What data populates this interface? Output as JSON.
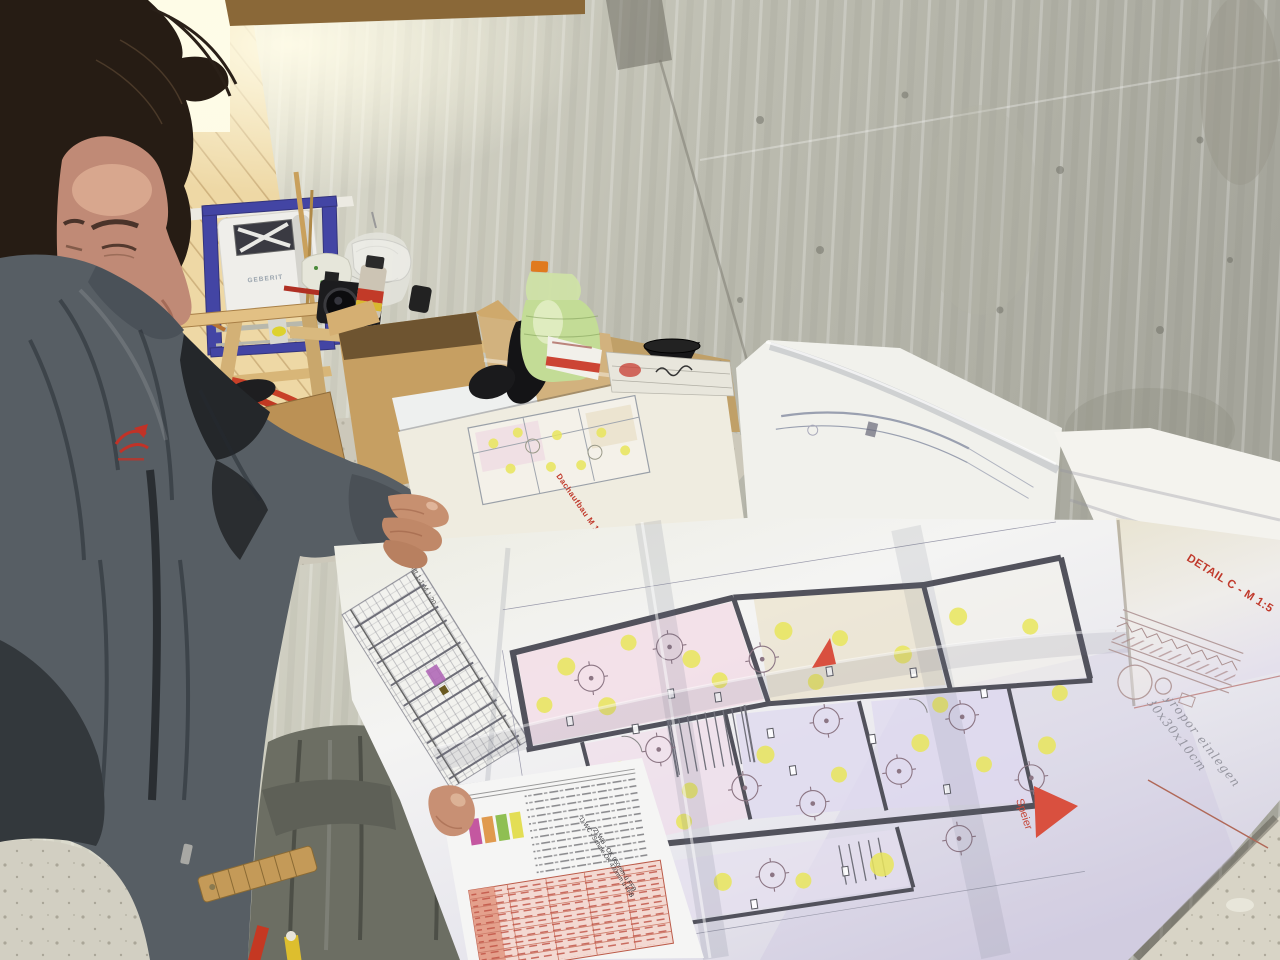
{
  "scene": {
    "type": "photograph",
    "setting": "Unfinished building interior with bare concrete wall, wooden attic framing and construction clutter",
    "subject": "Construction worker studying large unfolded architectural floor plans"
  },
  "environment": {
    "concrete_color": "#bfbfb3",
    "wood_color": "#e8d09c",
    "floor_color": "#d8d4c6"
  },
  "worker": {
    "jacket_color": "#575e64",
    "logo_color": "#c13227"
  },
  "fixtures": {
    "cistern_brand": "GEBERIT",
    "frame_blue": "#4345a4"
  },
  "items": {
    "bottle_green": "#c3dc96",
    "bottle_cap_orange": "#e07a1e",
    "pipe_red": "#c03822",
    "cardboard": "#c69f62"
  },
  "plans": {
    "detail_title": "DETAIL C - M 1:5",
    "note_line1": "Styropor einlegen",
    "note_line2": "30x30x10cm",
    "spout_label": "Speier",
    "roof_label": "Dachaufbau M 1:20",
    "section_label": "Schnitt 1-1 M 1:20",
    "legend_note_1": "1) WC - Schale OK 430mm ü FFB",
    "legend_note_2": "2) WB - OK 950mm ü FFB",
    "arrow_red": "#d9503f",
    "accent_red": "#c0392b",
    "highlight_yellow": "#e9e65c",
    "room_pink": "#f2dce6",
    "room_lilac": "#ded9ef",
    "legend_swatches": [
      "#c457a0",
      "#e09a4e",
      "#8fbf52",
      "#e3de55"
    ]
  }
}
